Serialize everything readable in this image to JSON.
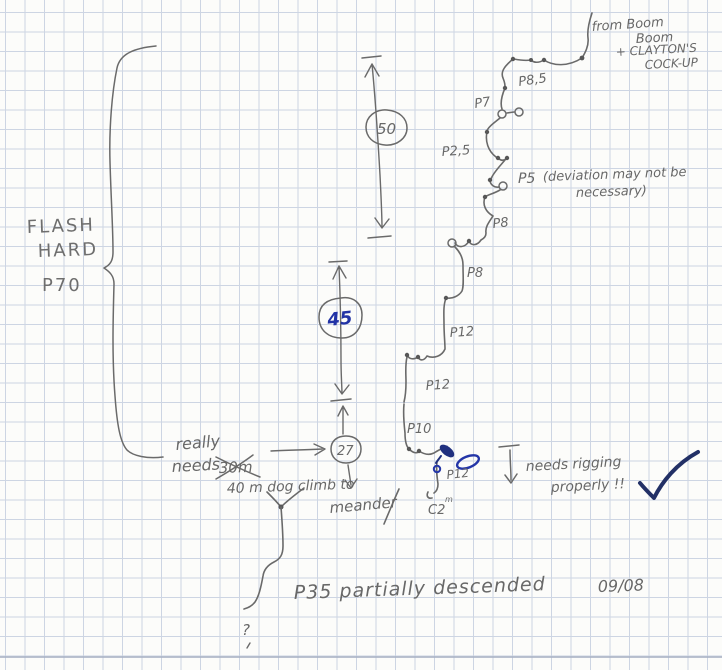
{
  "page": {
    "paper_color": "#fcfcfa",
    "grid_color": "#cdd5e3"
  },
  "colors": {
    "pencil": "#6a6a6a",
    "blue_ink": "#2233a6",
    "check_ink": "#223066"
  },
  "annotations": {
    "flash_line1": "FLASH",
    "flash_line2": "HARD",
    "flash_pitch": "P70",
    "origin_line1": "from Boom",
    "origin_line2": "Boom",
    "origin_line3": "+ CLAYTON'S",
    "origin_line4": "COCK-UP",
    "depth_upper": "50",
    "depth_middle": "45",
    "depth_lower": "27",
    "rope_note_line1": "really",
    "rope_note_line2": "needs",
    "rope_note_crossed": "30m",
    "rope_note_correction": "40 m dog climb to",
    "rope_note_target": "meander",
    "rigging_note_line1": "needs rigging",
    "rigging_note_line2": "properly !!",
    "bottom_note": "P35 partially descended",
    "bottom_date": "09/08",
    "unknown_mark": "?"
  },
  "pitches": {
    "p8_5": "P8,5",
    "p7": "P7",
    "p2_5": "P2,5",
    "p5": "P5",
    "p5_note_line1": "(deviation may not be",
    "p5_note_line2": "necessary)",
    "p8_upper": "P8",
    "p8_lower": "P8",
    "p12_upper": "P12",
    "p12_middle": "P12",
    "p10": "P10",
    "p12_lower": "P12",
    "c2": "C2",
    "c2_superscript": "m"
  }
}
